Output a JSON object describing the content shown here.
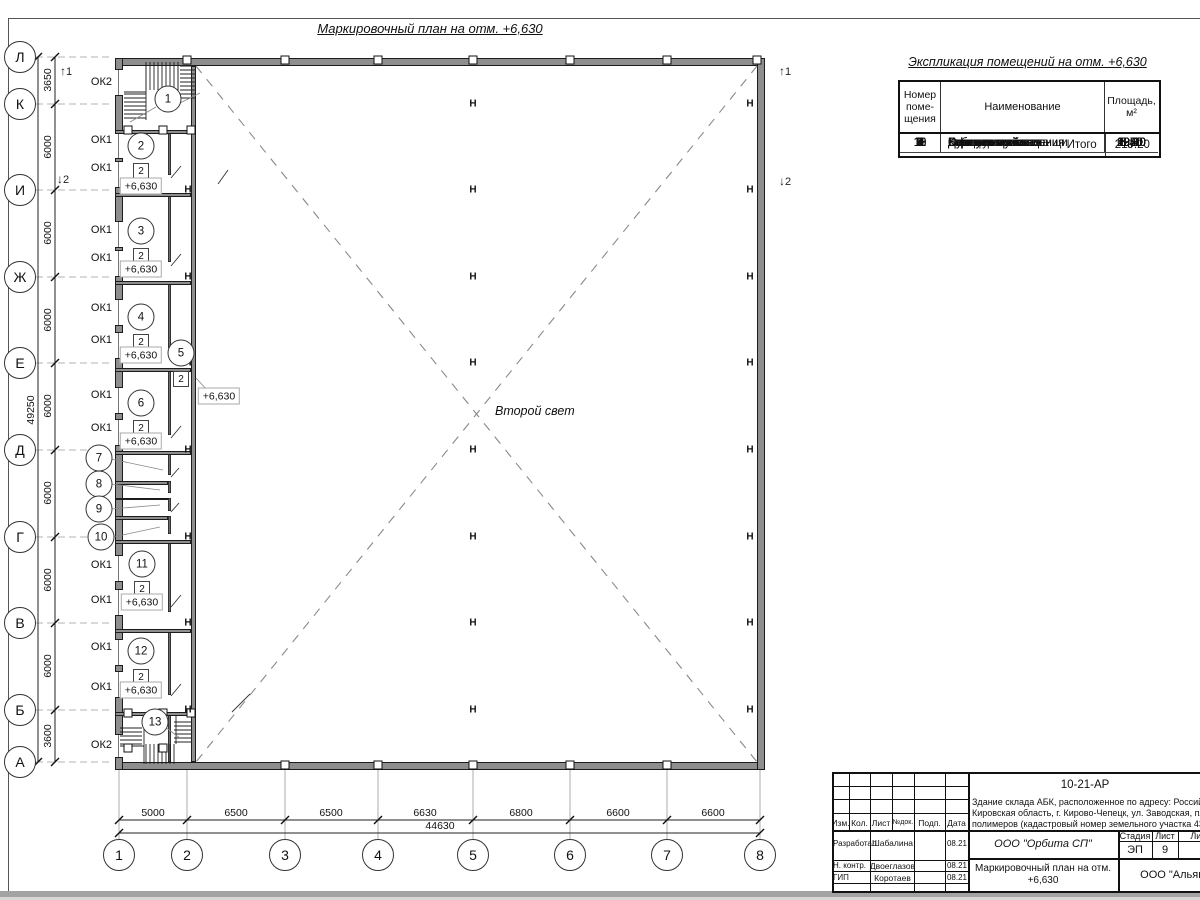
{
  "page": {
    "drawing_title": "Маркировочный план на отм. +6,630"
  },
  "plan": {
    "second_light": "Второй свет",
    "row_axes": [
      {
        "t": "Л",
        "y": 57
      },
      {
        "t": "К",
        "y": 104
      },
      {
        "t": "И",
        "y": 190
      },
      {
        "t": "Ж",
        "y": 277
      },
      {
        "t": "Е",
        "y": 363
      },
      {
        "t": "Д",
        "y": 450
      },
      {
        "t": "Г",
        "y": 537
      },
      {
        "t": "В",
        "y": 623
      },
      {
        "t": "Б",
        "y": 710
      },
      {
        "t": "А",
        "y": 762
      }
    ],
    "col_axes": [
      {
        "t": "1",
        "x": 119
      },
      {
        "t": "2",
        "x": 187
      },
      {
        "t": "3",
        "x": 285
      },
      {
        "t": "4",
        "x": 378
      },
      {
        "t": "5",
        "x": 473
      },
      {
        "t": "6",
        "x": 570
      },
      {
        "t": "7",
        "x": 667
      },
      {
        "t": "8",
        "x": 760
      }
    ],
    "v_dims": [
      {
        "t": "3650",
        "y": 80
      },
      {
        "t": "6000",
        "y": 147
      },
      {
        "t": "6000",
        "y": 233
      },
      {
        "t": "6000",
        "y": 320
      },
      {
        "t": "6000",
        "y": 406
      },
      {
        "t": "6000",
        "y": 493
      },
      {
        "t": "6000",
        "y": 580
      },
      {
        "t": "6000",
        "y": 666
      },
      {
        "t": "3600",
        "y": 736
      }
    ],
    "v_total": "49250",
    "h_dims": [
      {
        "t": "5000",
        "x": 153
      },
      {
        "t": "6500",
        "x": 236
      },
      {
        "t": "6500",
        "x": 331
      },
      {
        "t": "6630",
        "x": 425
      },
      {
        "t": "6800",
        "x": 521
      },
      {
        "t": "6600",
        "x": 618
      },
      {
        "t": "6600",
        "x": 713
      }
    ],
    "h_total": "44630",
    "ok_labels": [
      {
        "t": "ОК2",
        "x": 112,
        "y": 82
      },
      {
        "t": "ОК1",
        "x": 112,
        "y": 140
      },
      {
        "t": "ОК1",
        "x": 112,
        "y": 168
      },
      {
        "t": "ОК1",
        "x": 112,
        "y": 230
      },
      {
        "t": "ОК1",
        "x": 112,
        "y": 258
      },
      {
        "t": "ОК1",
        "x": 112,
        "y": 308
      },
      {
        "t": "ОК1",
        "x": 112,
        "y": 340
      },
      {
        "t": "ОК1",
        "x": 112,
        "y": 395
      },
      {
        "t": "ОК1",
        "x": 112,
        "y": 428
      },
      {
        "t": "ОК1",
        "x": 112,
        "y": 565
      },
      {
        "t": "ОК1",
        "x": 112,
        "y": 600
      },
      {
        "t": "ОК1",
        "x": 112,
        "y": 647
      },
      {
        "t": "ОК1",
        "x": 112,
        "y": 687
      },
      {
        "t": "ОК2",
        "x": 112,
        "y": 745
      }
    ],
    "rooms": [
      {
        "t": "1",
        "x": 168,
        "y": 99
      },
      {
        "t": "2",
        "x": 141,
        "y": 146
      },
      {
        "t": "3",
        "x": 141,
        "y": 231
      },
      {
        "t": "4",
        "x": 141,
        "y": 317
      },
      {
        "t": "5",
        "x": 181,
        "y": 353
      },
      {
        "t": "6",
        "x": 141,
        "y": 403
      },
      {
        "t": "7",
        "x": 99,
        "y": 458
      },
      {
        "t": "8",
        "x": 99,
        "y": 484
      },
      {
        "t": "9",
        "x": 99,
        "y": 509
      },
      {
        "t": "10",
        "x": 101,
        "y": 537
      },
      {
        "t": "11",
        "x": 142,
        "y": 564
      },
      {
        "t": "12",
        "x": 141,
        "y": 651
      },
      {
        "t": "13",
        "x": 155,
        "y": 722
      }
    ],
    "type_squares": [
      {
        "t": "2",
        "x": 141,
        "y": 171
      },
      {
        "t": "2",
        "x": 141,
        "y": 256
      },
      {
        "t": "2",
        "x": 141,
        "y": 342
      },
      {
        "t": "2",
        "x": 181,
        "y": 379
      },
      {
        "t": "2",
        "x": 141,
        "y": 428
      },
      {
        "t": "2",
        "x": 142,
        "y": 589
      },
      {
        "t": "2",
        "x": 141,
        "y": 677
      }
    ],
    "elev_labels": [
      {
        "t": "+6,630",
        "x": 141,
        "y": 186
      },
      {
        "t": "+6,630",
        "x": 141,
        "y": 269
      },
      {
        "t": "+6,630",
        "x": 141,
        "y": 355
      },
      {
        "t": "+6,630",
        "x": 141,
        "y": 441
      },
      {
        "t": "+6,630",
        "x": 142,
        "y": 602
      },
      {
        "t": "+6,630",
        "x": 141,
        "y": 690
      },
      {
        "t": "+6,630",
        "x": 219,
        "y": 396
      }
    ],
    "h_marks": [
      {
        "t": "Н",
        "x": 473,
        "y": 104
      },
      {
        "t": "Н",
        "x": 473,
        "y": 190
      },
      {
        "t": "Н",
        "x": 473,
        "y": 277
      },
      {
        "t": "Н",
        "x": 473,
        "y": 363
      },
      {
        "t": "Н",
        "x": 473,
        "y": 450
      },
      {
        "t": "Н",
        "x": 473,
        "y": 537
      },
      {
        "t": "Н",
        "x": 473,
        "y": 623
      },
      {
        "t": "Н",
        "x": 473,
        "y": 710
      },
      {
        "t": "Н",
        "x": 750,
        "y": 104
      },
      {
        "t": "Н",
        "x": 750,
        "y": 190
      },
      {
        "t": "Н",
        "x": 750,
        "y": 277
      },
      {
        "t": "Н",
        "x": 750,
        "y": 363
      },
      {
        "t": "Н",
        "x": 750,
        "y": 450
      },
      {
        "t": "Н",
        "x": 750,
        "y": 537
      },
      {
        "t": "Н",
        "x": 750,
        "y": 623
      },
      {
        "t": "Н",
        "x": 750,
        "y": 710
      },
      {
        "t": "Н",
        "x": 188,
        "y": 190
      },
      {
        "t": "Н",
        "x": 188,
        "y": 277
      },
      {
        "t": "Н",
        "x": 188,
        "y": 363
      },
      {
        "t": "Н",
        "x": 188,
        "y": 450
      },
      {
        "t": "Н",
        "x": 188,
        "y": 537
      },
      {
        "t": "Н",
        "x": 188,
        "y": 623
      },
      {
        "t": "Н",
        "x": 188,
        "y": 710
      }
    ],
    "squares": [
      {
        "x": 187,
        "y": 60
      },
      {
        "x": 285,
        "y": 60
      },
      {
        "x": 378,
        "y": 60
      },
      {
        "x": 473,
        "y": 60
      },
      {
        "x": 570,
        "y": 60
      },
      {
        "x": 667,
        "y": 60
      },
      {
        "x": 757,
        "y": 60
      },
      {
        "x": 285,
        "y": 765
      },
      {
        "x": 378,
        "y": 765
      },
      {
        "x": 473,
        "y": 765
      },
      {
        "x": 570,
        "y": 765
      },
      {
        "x": 667,
        "y": 765
      },
      {
        "x": 128,
        "y": 130
      },
      {
        "x": 163,
        "y": 130
      },
      {
        "x": 191,
        "y": 130
      },
      {
        "x": 128,
        "y": 713
      },
      {
        "x": 163,
        "y": 713
      },
      {
        "x": 191,
        "y": 713
      },
      {
        "x": 128,
        "y": 748
      },
      {
        "x": 163,
        "y": 748
      }
    ],
    "section_marks": [
      {
        "t": "1",
        "a": "↑",
        "x": 60,
        "y": 64
      },
      {
        "t": "2",
        "a": "↓",
        "x": 57,
        "y": 172
      },
      {
        "t": "1",
        "a": "↑",
        "x": 779,
        "y": 64
      },
      {
        "t": "2",
        "a": "↓",
        "x": 779,
        "y": 174
      }
    ],
    "walls": {
      "left_segs": [
        {
          "y": 58,
          "h": 12
        },
        {
          "y": 95,
          "h": 38
        },
        {
          "y": 158,
          "h": 4
        },
        {
          "y": 187,
          "h": 35
        },
        {
          "y": 247,
          "h": 4
        },
        {
          "y": 276,
          "h": 24
        },
        {
          "y": 325,
          "h": 8
        },
        {
          "y": 358,
          "h": 30
        },
        {
          "y": 413,
          "h": 7
        },
        {
          "y": 445,
          "h": 111
        },
        {
          "y": 581,
          "h": 9
        },
        {
          "y": 615,
          "h": 25
        },
        {
          "y": 665,
          "h": 7
        },
        {
          "y": 697,
          "h": 38
        },
        {
          "y": 757,
          "h": 13
        }
      ],
      "west_segs": [
        {
          "y": 130,
          "h": 45
        },
        {
          "y": 193,
          "h": 69
        },
        {
          "y": 281,
          "h": 67
        },
        {
          "y": 368,
          "h": 67
        },
        {
          "y": 453,
          "h": 22
        },
        {
          "y": 481,
          "h": 12
        },
        {
          "y": 498,
          "h": 13
        },
        {
          "y": 516,
          "h": 18
        },
        {
          "y": 540,
          "h": 72
        },
        {
          "y": 629,
          "h": 66
        },
        {
          "y": 712,
          "h": 50
        }
      ],
      "partitions": [
        {
          "x": 115,
          "y": 130,
          "w": 76,
          "h": 4
        },
        {
          "x": 115,
          "y": 193,
          "w": 76,
          "h": 4
        },
        {
          "x": 115,
          "y": 281,
          "w": 76,
          "h": 4
        },
        {
          "x": 115,
          "y": 368,
          "w": 76,
          "h": 4
        },
        {
          "x": 115,
          "y": 451,
          "w": 76,
          "h": 4
        },
        {
          "x": 115,
          "y": 481,
          "w": 53,
          "h": 4
        },
        {
          "x": 115,
          "y": 498,
          "w": 53,
          "h": 2
        },
        {
          "x": 115,
          "y": 516,
          "w": 53,
          "h": 4
        },
        {
          "x": 115,
          "y": 540,
          "w": 76,
          "h": 4
        },
        {
          "x": 115,
          "y": 629,
          "w": 76,
          "h": 4
        },
        {
          "x": 115,
          "y": 712,
          "w": 76,
          "h": 4
        }
      ]
    }
  },
  "schedule": {
    "title": "Экспликация помещений на отм. +6,630",
    "h_num": [
      "Номер",
      "поме-",
      "щения"
    ],
    "h_name": "Наименование",
    "h_area": [
      "Площадь,",
      "м²"
    ],
    "rows": [
      {
        "num": "1",
        "name": "Лестничная клетка",
        "area": "6,40"
      },
      {
        "num": "2",
        "name": "Офисные помещения",
        "area": "19,60"
      },
      {
        "num": "3",
        "name": "Офисные помещения",
        "area": "20,10"
      },
      {
        "num": "4",
        "name": "Комната приема пищи",
        "area": "20,10"
      },
      {
        "num": "5",
        "name": "Коридор",
        "area": "68,30"
      },
      {
        "num": "6",
        "name": "Бытовка женская",
        "area": "20,10"
      },
      {
        "num": "7",
        "name": "Душ женский",
        "area": "5,70"
      },
      {
        "num": "8",
        "name": "Сан. узел",
        "area": "3,60"
      },
      {
        "num": "9",
        "name": "Сан. узел",
        "area": "3,60"
      },
      {
        "num": "10",
        "name": "Душ мужской",
        "area": "5,70"
      },
      {
        "num": "11",
        "name": "Бытовка мужская",
        "area": "20,00"
      },
      {
        "num": "12",
        "name": "Кабинет",
        "area": "19,60"
      },
      {
        "num": "13",
        "name": "Лестнична клетка",
        "area": "6,40"
      }
    ],
    "total_label": "Итого",
    "total_value": "219.20"
  },
  "titleblock": {
    "code": "10-21-АР",
    "desc": [
      "Здание склада АБК, расположенное по адресу: Российская Федерация,",
      "Кировская область, г. Кирово-Чепецк, ул. Заводская, площадка завода",
      "полимеров (кадастровый номер земельного участка 43:42:000043)"
    ],
    "head_cols": [
      "Изм.",
      "Кол.",
      "Лист",
      "№док.",
      "Подп.",
      "Дата"
    ],
    "sig_rows": [
      {
        "role": "Разработал",
        "name": "Шабалина",
        "date": "08.21"
      },
      {
        "role": "Н. контр.",
        "name": "Двоеглазов",
        "date": "08.21"
      },
      {
        "role": "ГИП",
        "name": "Коротаев",
        "date": "08.21"
      }
    ],
    "org": "ООО \"Орбита СП\"",
    "stage_h": "Стадия",
    "sheet_h": "Лист",
    "sheets_h": "Листов",
    "stage": "ЭП",
    "sheet": "9",
    "sheets": "1",
    "doc_lines": [
      "Маркировочный план на отм.",
      "+6,630"
    ],
    "org2": "ООО \"Альянс"
  }
}
